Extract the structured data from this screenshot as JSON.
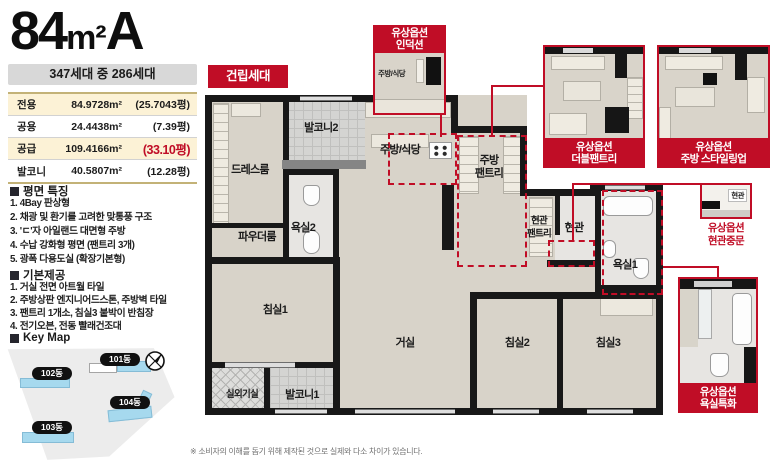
{
  "header": {
    "size": "84",
    "unit": "m²",
    "type": "A",
    "household": "347세대 중 286세대"
  },
  "area_table": {
    "rows": [
      {
        "label": "전용",
        "value": "84.9728m²",
        "pyeong": "(25.7043평)"
      },
      {
        "label": "공용",
        "value": "24.4438m²",
        "pyeong": "(7.39평)"
      },
      {
        "label": "공급",
        "value": "109.4166m²",
        "pyeong": "(33.10평)"
      },
      {
        "label": "발코니",
        "value": "40.5807m²",
        "pyeong": "(12.28평)"
      }
    ]
  },
  "features": {
    "title": "평면 특징",
    "items": [
      "1. 4Bay 판상형",
      "2. 채광 및 환기를 고려한 맞통풍 구조",
      "3. 'ㄷ'자 아일랜드 대면형 주방",
      "4. 수납 강화형 평면 (팬트리 3개)",
      "5. 광폭 다용도실 (확장기본형)"
    ]
  },
  "basics": {
    "title": "기본제공",
    "items": [
      "1. 거실 전면 아트월 타일",
      "2. 주방상판 엔지니어드스톤, 주방벽 타일",
      "3. 팬트리 1개소, 침실3 붙박이 반침장",
      "4. 전기오븐, 전동 빨래건조대"
    ]
  },
  "keymap": {
    "title": "Key Map",
    "buildings": [
      "101동",
      "102동",
      "103동",
      "104동"
    ]
  },
  "plan": {
    "built_label": "건립세대",
    "rooms": {
      "dressroom": "드레스룸",
      "balcony2": "발코니2",
      "kitchen": "주방/식당",
      "kitchen_pantry": "주방\n팬트리",
      "bath2": "욕실2",
      "powder": "파우더룸",
      "entry_pantry": "현관\n팬트리",
      "entry": "현관",
      "bath1": "욕실1",
      "bed1": "침실1",
      "living": "거실",
      "bed2": "침실2",
      "bed3": "침실3",
      "outdoor_unit": "실외기실",
      "balcony1": "발코니1"
    }
  },
  "options": [
    {
      "line1": "유상옵션",
      "line2": "인덕션",
      "thumb_label": "주방/식당"
    },
    {
      "line1": "유상옵션",
      "line2": "더블팬트리"
    },
    {
      "line1": "유상옵션",
      "line2": "주방 스타일링업"
    },
    {
      "line1": "유상옵션",
      "line2": "현관중문",
      "thumb_label": "현관"
    },
    {
      "line1": "유상옵션",
      "line2": "욕실특화"
    }
  ],
  "disclaimer": "※ 소비자의 이해를 돕기 위해 제작된 것으로 실제와 다소 차이가 있습니다.",
  "colors": {
    "red": "#c00d26",
    "cream": "#fcf2d6",
    "band_gray": "#d8d8d8",
    "building_blue": "#a6d9ee"
  }
}
